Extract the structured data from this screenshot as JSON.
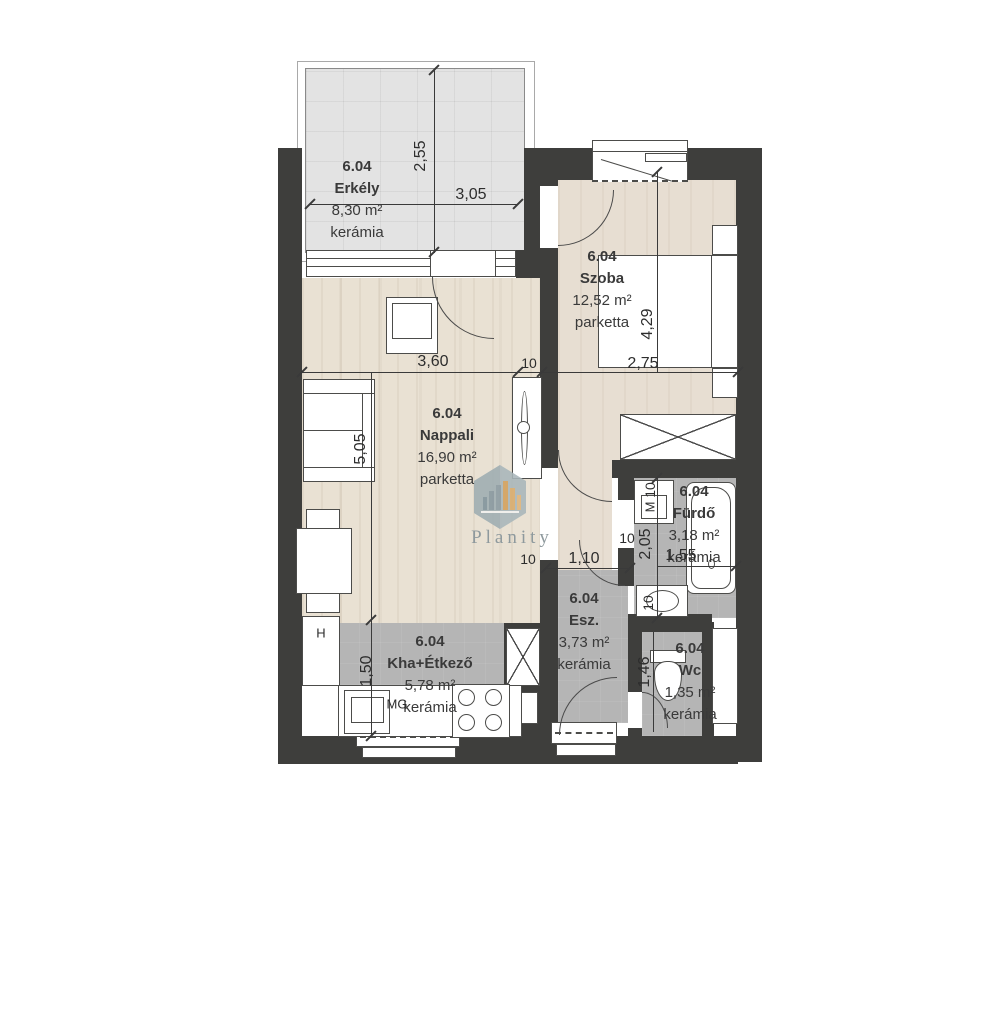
{
  "rooms": [
    {
      "code": "6.04",
      "name": "Erkély",
      "area": "8,30 m²",
      "material": "kerámia"
    },
    {
      "code": "6.04",
      "name": "Szoba",
      "area": "12,52 m²",
      "material": "parketta"
    },
    {
      "code": "6.04",
      "name": "Nappali",
      "area": "16,90 m²",
      "material": "parketta"
    },
    {
      "code": "6.04",
      "name": "Fürdő",
      "area": "3,18 m²",
      "material": "kerámia"
    },
    {
      "code": "6.04",
      "name": "Esz.",
      "area": "3,73 m²",
      "material": "kerámia"
    },
    {
      "code": "6.04",
      "name": "Kha+Étkező",
      "area": "5,78 m²",
      "material": "kerámia"
    },
    {
      "code": "6.04",
      "name": "Wc",
      "area": "1,35 m²",
      "material": "kerámia"
    }
  ],
  "dimensions": {
    "balcony_depth": "2,55",
    "balcony_width": "3,05",
    "nappali_width": "3,60",
    "nappali_depth": "5,05",
    "szoba_width": "2,75",
    "szoba_depth": "4,29",
    "hall_door_width": "1,10",
    "furdo_depth": "2,05",
    "furdo_width": "1,55",
    "kitchen_depth": "1,50",
    "wc_depth": "1,46",
    "wall_thickness": "10"
  },
  "appliance_marks": {
    "fridge": "H",
    "dishwasher": "MG",
    "washing_machine": "M"
  },
  "watermark": {
    "brand": "Planity"
  },
  "colors": {
    "wall": "#3e3e3c",
    "wet_floor": "#b5b5b5",
    "wood_floor": "#e9e1d3",
    "balcony_floor": "#e3e3e3",
    "logo": "#a9b6ba",
    "logo_accent": "#d2a05c"
  }
}
